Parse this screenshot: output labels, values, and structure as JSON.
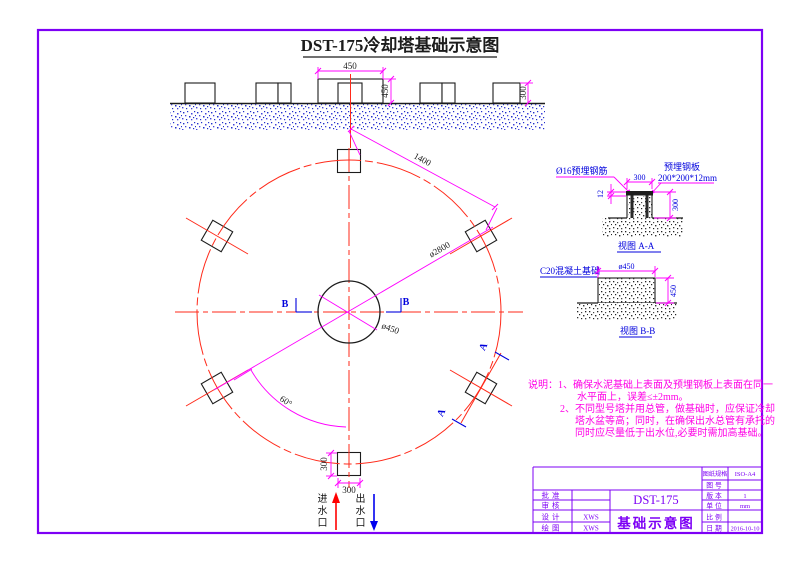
{
  "page": {
    "title": "DST-175冷却塔基础示意图"
  },
  "colors": {
    "frame_purple": "#7d00f5",
    "centerline_red": "#ff2a1a",
    "dimension_magenta": "#ff00ff",
    "label_blue": "#0000dd",
    "note_pink": "#ff00e6",
    "ink_black": "#1c1c1c"
  },
  "elevation": {
    "dim_top_width": "450",
    "dim_center_height": "450",
    "dim_block_height": "300"
  },
  "plan": {
    "dim_chord": "1400",
    "dim_bolt_circle": "ø2800",
    "dim_center_circle": "ø450",
    "dim_angle": "60°",
    "dim_block_height": "300",
    "dim_block_width": "300",
    "section_b": "B",
    "section_a": "A"
  },
  "detail_aa": {
    "label_rebar": "Ø16预埋钢筋",
    "label_plate_line1": "预埋钢板",
    "label_plate_line2": "200*200*12mm",
    "dim_width": "300",
    "dim_plate_thickness": "12",
    "dim_height": "300",
    "caption": "视图 A-A"
  },
  "detail_bb": {
    "label_concrete": "C20混凝土基础",
    "dim_diameter": "ø450",
    "dim_height": "450",
    "caption": "视图 B-B"
  },
  "notes": {
    "line1": "说明：1、确保水泥基础上表面及预埋钢板上表面在同一",
    "line2": "水平面上，误差≤±2mm。",
    "line3": "2、不同型号塔并用总管，做基础时，应保证冷却",
    "line4": "塔水盆等高；同时，在确保出水总管有承托的",
    "line5": "同时应尽量低于出水位,必要时需加高基础。"
  },
  "flow": {
    "inlet": "进水口",
    "outlet": "出水口"
  },
  "titleblock": {
    "left_rows": [
      {
        "label": "批准",
        "value": ""
      },
      {
        "label": "审核",
        "value": ""
      },
      {
        "label": "设计",
        "value": "XWS"
      },
      {
        "label": "绘图",
        "value": "XWS"
      }
    ],
    "model": "DST-175",
    "drawing_name": "基础示意图",
    "right_rows": [
      {
        "label": "图纸规格",
        "value": "ISO-A4"
      },
      {
        "label": "图号",
        "value": ""
      },
      {
        "label": "版本",
        "value": "1"
      },
      {
        "label": "单位",
        "value": "mm"
      },
      {
        "label": "比例",
        "value": ""
      },
      {
        "label": "日期",
        "value": "2016-10-10"
      }
    ]
  }
}
